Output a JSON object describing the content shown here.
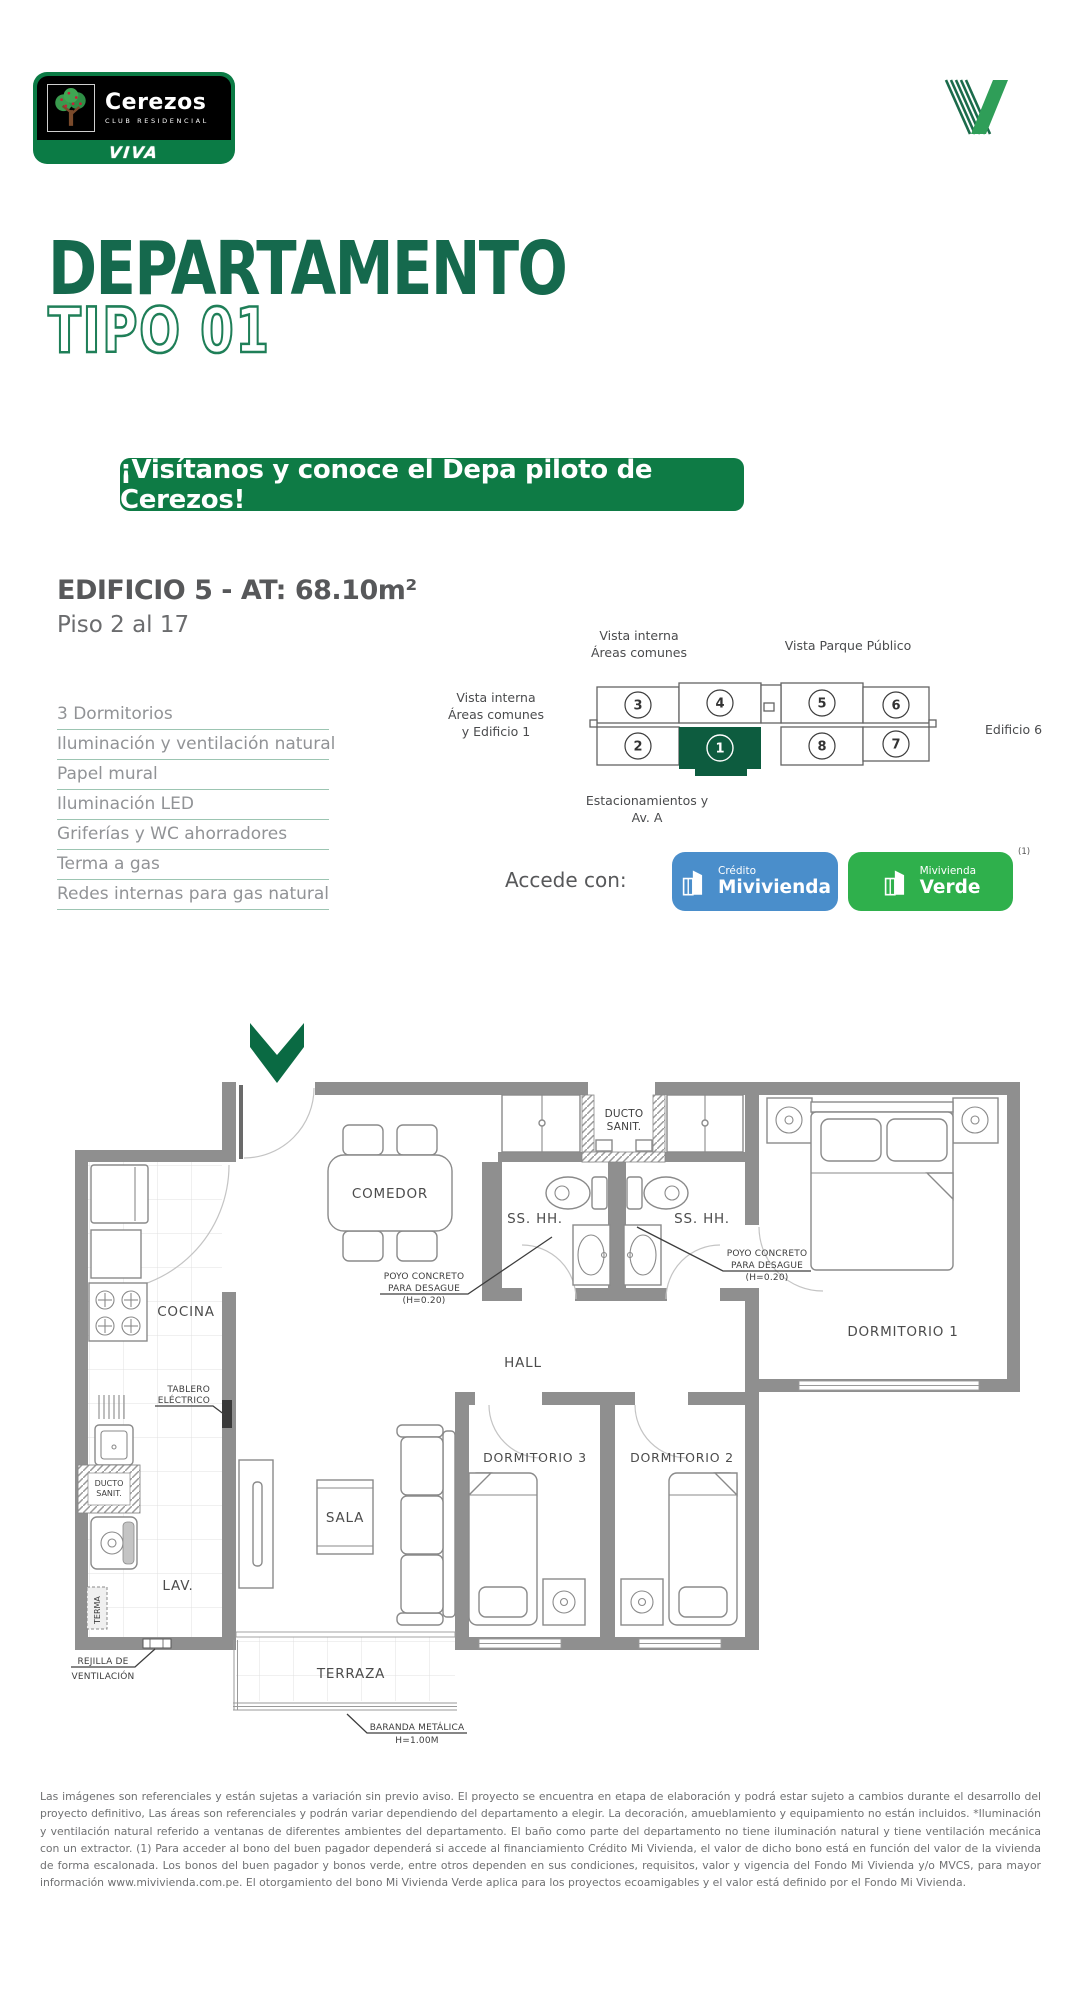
{
  "brand": {
    "name": "Cerezos",
    "tagline": "CLUB RESIDENCIAL",
    "viva": "VIVA"
  },
  "title": {
    "main": "DEPARTAMENTO",
    "sub": "TIPO 01"
  },
  "banner": "¡Visítanos y conoce el Depa piloto de Cerezos!",
  "building": {
    "heading": "EDIFICIO 5 - AT: 68.10m²",
    "floors": "Piso 2 al 17"
  },
  "features": [
    "3 Dormitorios",
    "Iluminación y ventilación natural",
    "Papel mural",
    "Iluminación LED",
    "Griferías y WC ahorradores",
    "Terma a gas",
    "Redes internas para gas natural"
  ],
  "keyplan": {
    "labels": {
      "top_left": [
        "Vista interna",
        "Áreas comunes"
      ],
      "top_right": "Vista Parque Público",
      "left": [
        "Vista interna",
        "Áreas comunes",
        "y Edificio 1"
      ],
      "right": "Edificio 6",
      "bottom": [
        "Estacionamientos y",
        "Av. A"
      ]
    },
    "units": [
      "3",
      "4",
      "5",
      "6",
      "2",
      "1",
      "8",
      "7"
    ],
    "highlighted_unit": "1"
  },
  "access": {
    "label": "Accede con:",
    "note": "(1)",
    "credito": {
      "top": "Crédito",
      "bottom": "Mivivienda"
    },
    "verde": {
      "top": "Mivivienda",
      "bottom": "Verde"
    }
  },
  "floorplan": {
    "rooms": {
      "comedor": "COMEDOR",
      "cocina": "COCINA",
      "sshh": "SS. HH.",
      "dorm1": "DORMITORIO 1",
      "dorm2": "DORMITORIO 2",
      "dorm3": "DORMITORIO 3",
      "hall": "HALL",
      "sala": "SALA",
      "lav": "LAV.",
      "terraza": "TERRAZA",
      "terma": "TERMA"
    },
    "annotations": {
      "ducto": [
        "DUCTO",
        "SANIT."
      ],
      "poyo": [
        "POYO CONCRETO",
        "PARA DESAGUE",
        "(H=0.20)"
      ],
      "tablero": [
        "TABLERO",
        "ELÉCTRICO"
      ],
      "rejilla": [
        "REJILLA DE",
        "VENTILACIÓN"
      ],
      "baranda": [
        "BARANDA METÁLICA",
        "H=1.00M"
      ]
    }
  },
  "colors": {
    "dark_green": "#15694d",
    "banner_green": "#0e7b45",
    "unit_green": "#0d5c3f",
    "credito_blue": "#4a8ecb",
    "verde_green": "#2fb04c"
  },
  "disclaimer": "Las imágenes son referenciales y están sujetas a variación sin previo aviso. El proyecto se encuentra en etapa de elaboración y podrá estar sujeto a cambios durante el desarrollo del proyecto definitivo, Las áreas son referenciales y podrán variar dependiendo del departamento a elegir. La decoración, amueblamiento y equipamiento no están incluidos. *Iluminación y ventilación natural referido a ventanas de diferentes ambientes del departamento. El baño como parte del departamento no tiene iluminación natural y tiene ventilación mecánica con un extractor. (1) Para acceder al bono del buen pagador dependerá si accede al financiamiento Crédito Mi Vivienda, el valor de dicho bono está en función del valor de la vivienda de forma escalonada. Los bonos del buen pagador y bonos verde, entre otros dependen en sus condiciones, requisitos, valor y vigencia del Fondo Mi Vivienda y/o MVCS, para mayor información www.mivivienda.com.pe. El otorgamiento del bono Mi Vivienda Verde aplica para los proyectos ecoamigables y el valor está definido por el Fondo Mi Vivienda."
}
